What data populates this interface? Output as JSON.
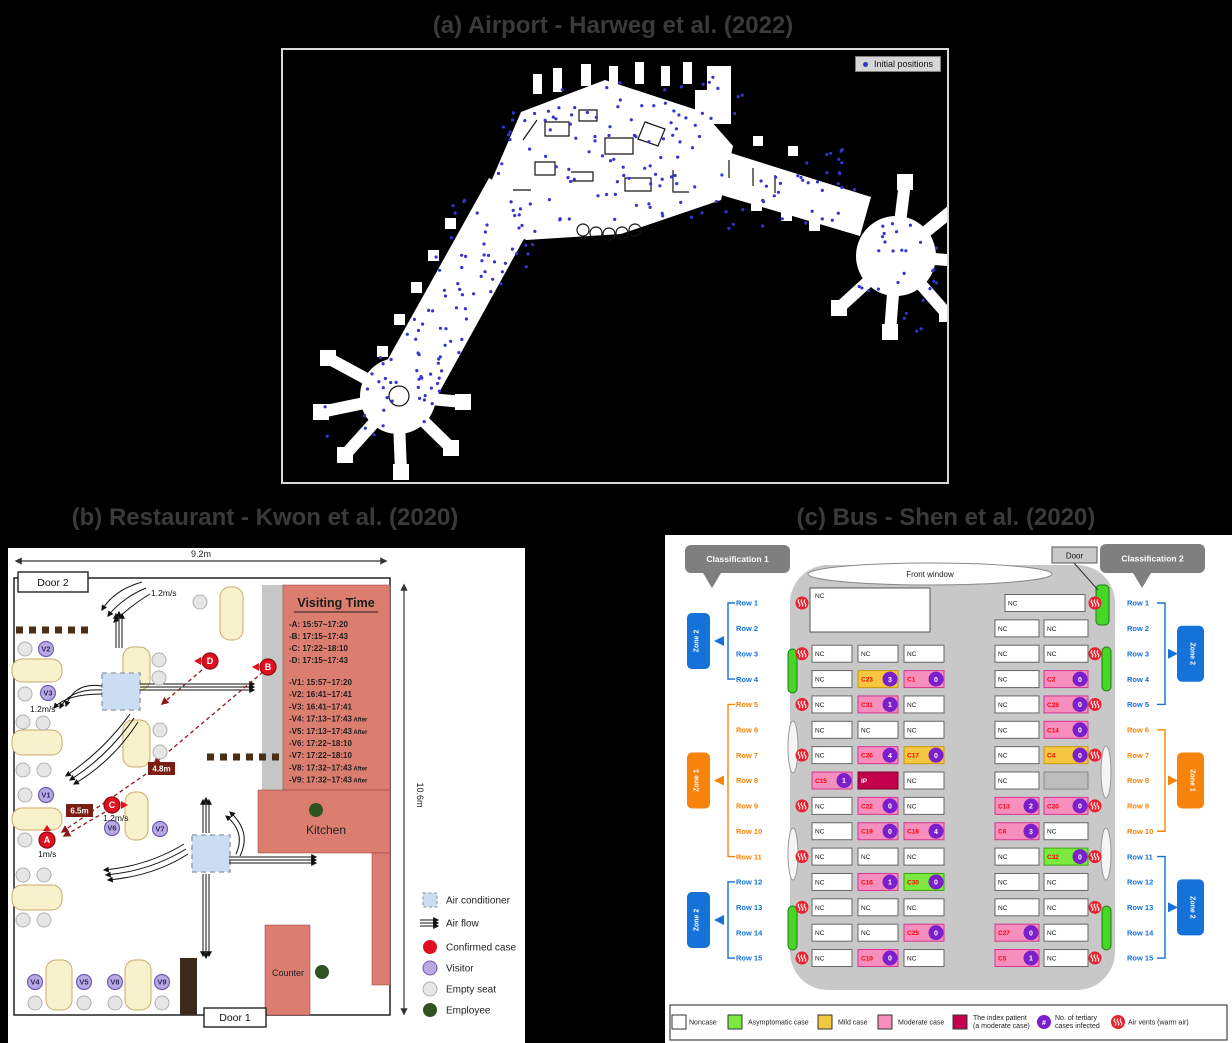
{
  "page": {
    "bg": "#000000",
    "title_color": "#3a3a3a"
  },
  "panel_a": {
    "title": "(a) Airport - Harweg et al. (2022)",
    "legend_label": "Initial positions",
    "dot_color": "#3434d0",
    "dots": {
      "count_hint": 265,
      "seed": 42
    }
  },
  "panel_b": {
    "title": "(b) Restaurant - Kwon et al. (2020)",
    "width_label": "9.2m",
    "height_label": "10.6m",
    "door1": "Door 1",
    "door2": "Door 2",
    "kitchen": "Kitchen",
    "counter": "Counter",
    "visiting_time": {
      "title": "Visiting Time",
      "cases": [
        {
          "id": "A",
          "time": "15:57~17:20"
        },
        {
          "id": "B",
          "time": "17:15~17:43"
        },
        {
          "id": "C",
          "time": "17:22~18:10"
        },
        {
          "id": "D",
          "time": "17:15~17:43"
        }
      ],
      "visitors": [
        {
          "id": "V1",
          "time": "15:57~17:20"
        },
        {
          "id": "V2",
          "time": "16:41~17:41"
        },
        {
          "id": "V3",
          "time": "16:41~17:41"
        },
        {
          "id": "V4",
          "time": "17:13~17:43",
          "after": true
        },
        {
          "id": "V5",
          "time": "17:13~17:43",
          "after": true
        },
        {
          "id": "V6",
          "time": "17:22~18:10"
        },
        {
          "id": "V7",
          "time": "17:22~18:10"
        },
        {
          "id": "V8",
          "time": "17:32~17:43",
          "after": true
        },
        {
          "id": "V9",
          "time": "17:32~17:43",
          "after": true
        }
      ]
    },
    "distance_labels": [
      {
        "label": "4.8m",
        "x": 140,
        "y": 214
      },
      {
        "label": "6.5m",
        "x": 58,
        "y": 256
      }
    ],
    "flow_labels": [
      {
        "label": "1.2m/s",
        "x": 143,
        "y": 48
      },
      {
        "label": "1.2m/s",
        "x": 22,
        "y": 164
      },
      {
        "label": "1.2m/s",
        "x": 95,
        "y": 273
      },
      {
        "label": "1m/s",
        "x": 30,
        "y": 309
      }
    ],
    "visitors": [
      {
        "id": "V1",
        "x": 38,
        "y": 247
      },
      {
        "id": "V2",
        "x": 38,
        "y": 101
      },
      {
        "id": "V3",
        "x": 40,
        "y": 145
      },
      {
        "id": "V4",
        "x": 27,
        "y": 434
      },
      {
        "id": "V5",
        "x": 76,
        "y": 434
      },
      {
        "id": "V6",
        "x": 104,
        "y": 280
      },
      {
        "id": "V7",
        "x": 152,
        "y": 281
      },
      {
        "id": "V8",
        "x": 107,
        "y": 434
      },
      {
        "id": "V9",
        "x": 154,
        "y": 434
      }
    ],
    "confirmed": [
      {
        "id": "A",
        "x": 39,
        "y": 292,
        "tri": "up"
      },
      {
        "id": "B",
        "x": 260,
        "y": 119,
        "tri": "left"
      },
      {
        "id": "C",
        "x": 104,
        "y": 257,
        "tri": "right"
      },
      {
        "id": "D",
        "x": 202,
        "y": 113,
        "tri": "left"
      }
    ],
    "employees": [
      [
        308,
        262
      ],
      [
        314,
        424
      ]
    ],
    "legend": [
      {
        "type": "ac",
        "label": "Air conditioner"
      },
      {
        "type": "flow",
        "label": "Air flow"
      },
      {
        "type": "confirmed",
        "label": "Confirmed case"
      },
      {
        "type": "visitor",
        "label": "Visitor"
      },
      {
        "type": "empty",
        "label": "Empty seat"
      },
      {
        "type": "employee",
        "label": "Employee"
      }
    ],
    "colors": {
      "case_red": "#E01020",
      "visitor_purple": "#B9A9E2",
      "empty_gray": "#E6E6E6",
      "employee_green": "#2F5422",
      "room_red": "#DB7E70",
      "table_yellow": "#F8F2CC",
      "ac_blue": "#CBDDF2",
      "dist_box": "#7A1D12"
    }
  },
  "panel_c": {
    "title": "(c) Bus - Shen et al. (2020)",
    "classification1": "Classification 1",
    "classification2": "Classification 2",
    "door_label": "Door",
    "front_window": "Front window",
    "driver_seat": "NC",
    "row_prefix": "Row",
    "vent_rows": [
      1,
      3,
      5,
      7,
      9,
      11,
      13,
      15
    ],
    "zones_left": [
      {
        "label": "Zone 2",
        "rows": [
          1,
          4
        ],
        "zone": "zone2"
      },
      {
        "label": "Zone 1",
        "rows": [
          5,
          11
        ],
        "zone": "zone1"
      },
      {
        "label": "Zone 2",
        "rows": [
          12,
          15
        ],
        "zone": "zone2"
      }
    ],
    "zones_right": [
      {
        "label": "Zone 2",
        "rows": [
          1,
          5
        ],
        "zone": "zone2"
      },
      {
        "label": "Zone 1",
        "rows": [
          6,
          10
        ],
        "zone": "zone1"
      },
      {
        "label": "Zone 2",
        "rows": [
          11,
          15
        ],
        "zone": "zone2"
      }
    ],
    "left_rows": [
      {
        "row": 3,
        "seats": [
          {
            "label": "NC"
          },
          {
            "label": "NC"
          },
          {
            "label": "NC"
          }
        ]
      },
      {
        "row": 4,
        "seats": [
          {
            "label": "NC"
          },
          {
            "label": "C23",
            "type": "mild",
            "n": 3
          },
          {
            "label": "C1",
            "type": "moderate",
            "n": 0
          }
        ]
      },
      {
        "row": 5,
        "seats": [
          {
            "label": "NC"
          },
          {
            "label": "C31",
            "type": "moderate",
            "n": 1
          },
          {
            "label": "NC"
          }
        ]
      },
      {
        "row": 6,
        "seats": [
          {
            "label": "NC"
          },
          {
            "label": "NC"
          },
          {
            "label": "NC"
          }
        ]
      },
      {
        "row": 7,
        "seats": [
          {
            "label": "NC"
          },
          {
            "label": "C26",
            "type": "moderate",
            "n": 4
          },
          {
            "label": "C17",
            "type": "mild",
            "n": 0
          }
        ]
      },
      {
        "row": 8,
        "seats": [
          {
            "label": "C15",
            "type": "moderate",
            "n": 1
          },
          {
            "label": "IP",
            "type": "index"
          },
          {
            "label": "NC"
          }
        ]
      },
      {
        "row": 9,
        "seats": [
          {
            "label": "NC"
          },
          {
            "label": "C22",
            "type": "moderate",
            "n": 0
          },
          {
            "label": "NC"
          }
        ]
      },
      {
        "row": 10,
        "seats": [
          {
            "label": "NC"
          },
          {
            "label": "C19",
            "type": "moderate",
            "n": 0
          },
          {
            "label": "C18",
            "type": "moderate",
            "n": 4
          }
        ]
      },
      {
        "row": 11,
        "seats": [
          {
            "label": "NC"
          },
          {
            "label": "NC"
          },
          {
            "label": "NC"
          }
        ]
      },
      {
        "row": 12,
        "seats": [
          {
            "label": "NC"
          },
          {
            "label": "C16",
            "type": "moderate",
            "n": 1
          },
          {
            "label": "C30",
            "type": "asymptomatic",
            "n": 0
          }
        ]
      },
      {
        "row": 13,
        "seats": [
          {
            "label": "NC"
          },
          {
            "label": "NC"
          },
          {
            "label": "NC"
          }
        ]
      },
      {
        "row": 14,
        "seats": [
          {
            "label": "NC"
          },
          {
            "label": "NC"
          },
          {
            "label": "C25",
            "type": "moderate",
            "n": 0
          }
        ]
      },
      {
        "row": 15,
        "seats": [
          {
            "label": "NC"
          },
          {
            "label": "C10",
            "type": "moderate",
            "n": 0
          },
          {
            "label": "NC"
          }
        ]
      }
    ],
    "right_rows": [
      {
        "row": 1,
        "wide": true,
        "seats": [
          {
            "label": "NC"
          }
        ]
      },
      {
        "row": 2,
        "seats": [
          {
            "label": "NC"
          },
          {
            "label": "NC"
          }
        ]
      },
      {
        "row": 3,
        "seats": [
          {
            "label": "NC"
          },
          {
            "label": "NC"
          }
        ]
      },
      {
        "row": 4,
        "seats": [
          {
            "label": "NC"
          },
          {
            "label": "C2",
            "type": "moderate",
            "n": 0
          }
        ]
      },
      {
        "row": 5,
        "seats": [
          {
            "label": "NC"
          },
          {
            "label": "C28",
            "type": "moderate",
            "n": 0
          }
        ]
      },
      {
        "row": 6,
        "seats": [
          {
            "label": "NC"
          },
          {
            "label": "C14",
            "type": "moderate",
            "n": 0
          }
        ]
      },
      {
        "row": 7,
        "seats": [
          {
            "label": "NC"
          },
          {
            "label": "C4",
            "type": "mild",
            "n": 0
          }
        ]
      },
      {
        "row": 8,
        "seats": [
          {
            "label": "NC"
          },
          {
            "type": "empty"
          }
        ]
      },
      {
        "row": 9,
        "seats": [
          {
            "label": "C13",
            "type": "moderate",
            "n": 2
          },
          {
            "label": "C20",
            "type": "moderate",
            "n": 0
          }
        ]
      },
      {
        "row": 10,
        "seats": [
          {
            "label": "C6",
            "type": "moderate",
            "n": 3
          },
          {
            "label": "NC"
          }
        ]
      },
      {
        "row": 11,
        "seats": [
          {
            "label": "NC"
          },
          {
            "label": "C32",
            "type": "asymptomatic",
            "n": 0
          }
        ]
      },
      {
        "row": 12,
        "seats": [
          {
            "label": "NC"
          },
          {
            "label": "NC"
          }
        ]
      },
      {
        "row": 13,
        "seats": [
          {
            "label": "NC"
          },
          {
            "label": "NC"
          }
        ]
      },
      {
        "row": 14,
        "seats": [
          {
            "label": "C27",
            "type": "moderate",
            "n": 0
          },
          {
            "label": "NC"
          }
        ]
      },
      {
        "row": 15,
        "seats": [
          {
            "label": "C5",
            "type": "moderate",
            "n": 1
          },
          {
            "label": "NC"
          }
        ]
      }
    ],
    "legend": [
      {
        "type": "noncase",
        "label": "Noncase"
      },
      {
        "type": "asymptomatic",
        "label": "Asymptomatic case"
      },
      {
        "type": "mild",
        "label": "Mild case"
      },
      {
        "type": "moderate",
        "label": "Moderate case"
      },
      {
        "type": "index",
        "label": "The index patient",
        "label2": "(a moderate case)"
      },
      {
        "type": "tertiary",
        "label": "No. of tertiary",
        "label2": "cases infected",
        "symbol": "#"
      },
      {
        "type": "vent",
        "label": "Air vents (warm air)"
      }
    ],
    "colors": {
      "noncase": "#FFFFFF",
      "asymptomatic": "#7CE93E",
      "mild": "#F5C63F",
      "moderate": "#F78FBE",
      "index": "#C4004C",
      "tertiary": "#7A1FC9",
      "vent": "#E8212E",
      "zone1": "#F8830A",
      "zone2": "#1472D8",
      "bus_gray": "#C8C8C8",
      "window_open": "#45D626",
      "empty": "#BDBDBD"
    }
  }
}
